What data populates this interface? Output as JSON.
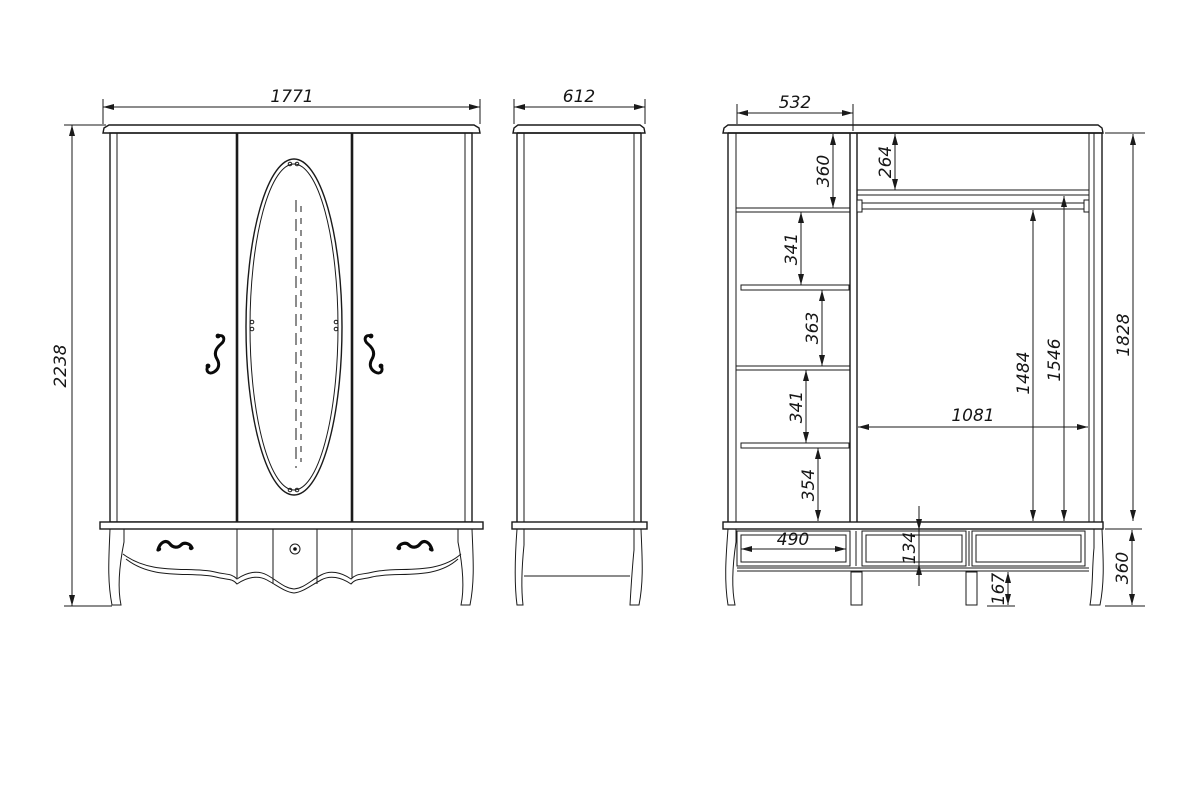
{
  "style": {
    "background": "#ffffff",
    "line_color": "#1a1a1a"
  },
  "dimensions": {
    "front": {
      "width": "1771",
      "height": "2238"
    },
    "side": {
      "depth": "612"
    },
    "section": {
      "left_column_width": "532",
      "top_compartment": "360",
      "compartment_2": "341",
      "compartment_3": "363",
      "compartment_4": "341",
      "compartment_5": "354",
      "top_shelf_drop": "264",
      "rod_clearance": "1484",
      "shelf_clearance": "1546",
      "interior_height": "1828",
      "hanging_section_width": "1081",
      "drawer_width": "490",
      "drawer_opening_height": "134",
      "underframe_clearance": "167",
      "base_height": "360"
    }
  }
}
